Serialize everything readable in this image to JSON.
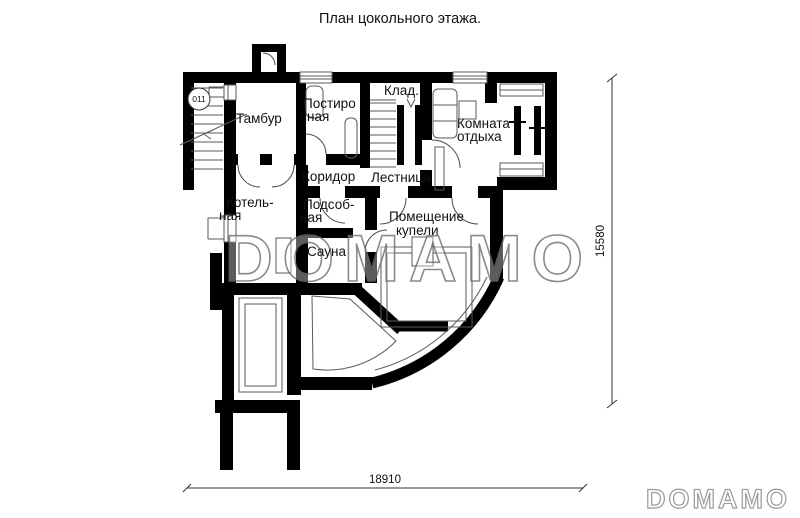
{
  "title": "План цокольного этажа.",
  "marker": {
    "label": "011"
  },
  "rooms": {
    "tambur": {
      "label": "Тамбур"
    },
    "postirochnaya": {
      "line1": "Постиро",
      "line2": "чная"
    },
    "klad": {
      "label": "Клад."
    },
    "komnata": {
      "line1": "Комната",
      "line2": "отдыха"
    },
    "koridor": {
      "label": "Коридор"
    },
    "lestnitsa": {
      "label": "Лестница"
    },
    "kotelnaya": {
      "line1": "Котель-",
      "line2": "ная"
    },
    "podsobnaya": {
      "line1": "Подсоб-",
      "line2": "ная"
    },
    "sauna": {
      "label": "Сауна"
    },
    "kupel": {
      "line1": "Помещение",
      "line2": "купели"
    }
  },
  "dimensions": {
    "width": "18910",
    "height": "15580"
  },
  "watermark": {
    "center": "DOMAMO",
    "corner": "DOMAMO"
  },
  "colors": {
    "wall": "#000000",
    "thin_line": "#5a5a5a",
    "watermark_center": "#6e6e6e",
    "watermark_corner": "#9a9a9a",
    "label": "#111111",
    "background": "#ffffff"
  }
}
